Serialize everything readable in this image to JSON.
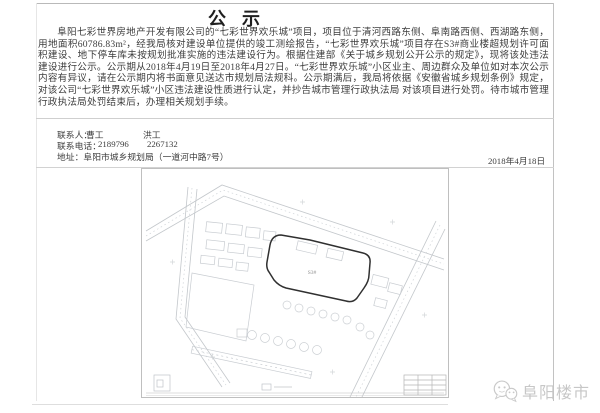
{
  "document": {
    "title": "公示",
    "body": "阜阳七彩世界房地产开发有限公司的“七彩世界欢乐城”项目，项目位于清河西路东侧、阜南路西侧、西湖路东侧，用地面积60786.83m²，经我局核对建设单位提供的竣工测绘报告，“七彩世界欢乐城”项目存在S3#商业楼超规划许可面积建设、地下停车库未按规划批准实施的违法建设行为。根据住建部《关于城乡规划公开公示的规定》，现将该处违法建设进行公示。公示期从2018年4月19日至2018年4月27日。“七彩世界欢乐城”小区业主、周边群众及单位如对本次公示内容有异议，请在公示期内将书面意见送达市规划局法规科。公示期满后，我局将依据《安徽省城乡规划条例》规定，对该公司“七彩世界欢乐城”小区违法建设性质进行认定，并抄告城市管理行政执法局 对该项目进行处罚。待市城市管理行政执法局处罚结束后，办理相关规划手续。",
    "contacts": {
      "person_label": "联系人：",
      "person_1": "曹工",
      "person_2": "洪工",
      "phone_label": "联系电话：",
      "phone_1": "2189796",
      "phone_2": "2267132",
      "address": "地址：阜阳市城乡规划局（一道河中路7号）"
    },
    "date": "2018年4月18日",
    "site_plan": {
      "building_label": "S3#"
    },
    "watermark": {
      "name": "阜阳楼市"
    },
    "colors": {
      "text": "#3d3d3d",
      "frame_line": "#c8c8c8",
      "plan_line": "#c5c9cd",
      "plan_highlight": "#303030",
      "watermark": "#c7c7c7"
    }
  }
}
